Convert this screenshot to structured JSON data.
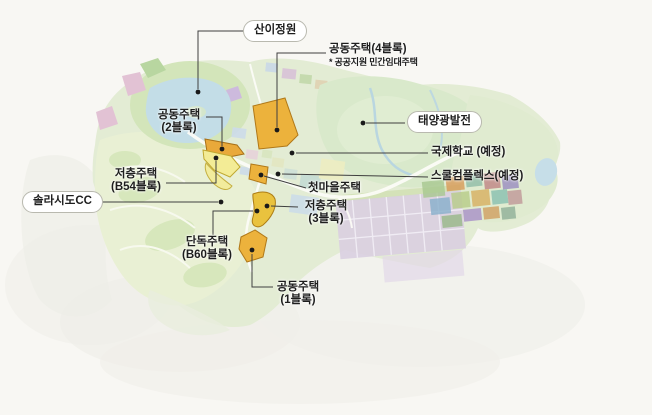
{
  "labels": {
    "sani_garden": {
      "text": "산이정원"
    },
    "apt_block4": {
      "text": "공동주택(4블록)",
      "note": "* 공공지원 민간임대주택"
    },
    "apt_block2": {
      "line1": "공동주택",
      "line2": "(2블록)"
    },
    "solar_power": {
      "text": "태양광발전"
    },
    "intl_school": {
      "text": "국제학교 (예정)"
    },
    "school_complex": {
      "text": "스쿨컴플렉스(예정)"
    },
    "first_village": {
      "text": "첫마을주택"
    },
    "lowrise_block3": {
      "line1": "저층주택",
      "line2": "(3블록)"
    },
    "lowrise_b54": {
      "line1": "저층주택",
      "line2": "(B54블록)"
    },
    "solaseado_cc": {
      "text": "솔라시도CC"
    },
    "detached_b60": {
      "line1": "단독주택",
      "line2": "(B60블록)"
    },
    "apt_block1": {
      "line1": "공동주택",
      "line2": "(1블록)"
    }
  },
  "colors": {
    "highlight_block": "#ecb23c",
    "highlight_block_light": "#f3ec96",
    "land": "#e3ecd4",
    "lake": "#c3dde7",
    "solar_field_grid": "#d9cfe0",
    "leader_line": "#3f3f3f",
    "dot": "#1a1a1a",
    "pill_border": "#b9b9af"
  }
}
